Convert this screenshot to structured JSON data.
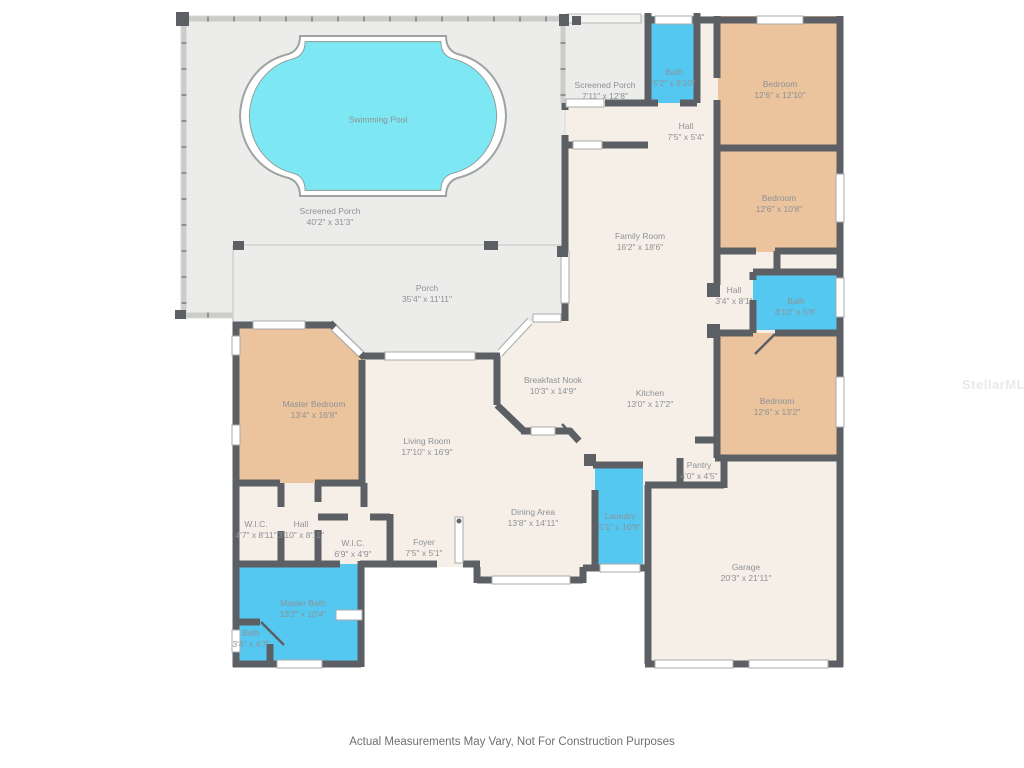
{
  "colors": {
    "pool": "#7DE8F4",
    "wet": "#55C8F2",
    "bedroom": "#EBC39D",
    "floor": "#F6EFE7",
    "porch": "#ECECEA",
    "wall": "#5C6064",
    "label": "#8C9296"
  },
  "rooms": [
    {
      "name": "Swimming Pool",
      "dims": ""
    },
    {
      "name": "Screened Porch",
      "dims": "40'2\" x 31'3\""
    },
    {
      "name": "Porch",
      "dims": "35'4\" x 11'11\""
    },
    {
      "name": "Screened Porch",
      "dims": "7'11\" x 12'8\""
    },
    {
      "name": "Bath",
      "dims": "5'2\" x 8'10\""
    },
    {
      "name": "Bedroom",
      "dims": "12'6\" x 12'10\""
    },
    {
      "name": "Hall",
      "dims": "7'5\" x 5'4\""
    },
    {
      "name": "Family Room",
      "dims": "16'2\" x 18'6\""
    },
    {
      "name": "Bedroom",
      "dims": "12'6\" x 10'8\""
    },
    {
      "name": "Hall",
      "dims": "3'4\" x 8'1\""
    },
    {
      "name": "Bath",
      "dims": "8'10\" x 5'6\""
    },
    {
      "name": "Bedroom",
      "dims": "12'6\" x 13'2\""
    },
    {
      "name": "Master Bedroom",
      "dims": "13'4\" x 16'8\""
    },
    {
      "name": "Living Room",
      "dims": "17'10\" x 16'9\""
    },
    {
      "name": "Breakfast Nook",
      "dims": "10'3\" x 14'9\""
    },
    {
      "name": "Kitchen",
      "dims": "13'0\" x 17'2\""
    },
    {
      "name": "Pantry",
      "dims": "4'0\" x 4'5\""
    },
    {
      "name": "Dining Area",
      "dims": "13'8\" x 14'11\""
    },
    {
      "name": "Laundry",
      "dims": "5'1\" x 10'8\""
    },
    {
      "name": "W.I.C.",
      "dims": "4'7\" x 8'11\""
    },
    {
      "name": "Hall",
      "dims": "3'10\" x 8'11\""
    },
    {
      "name": "W.I.C.",
      "dims": "6'9\" x 4'9\""
    },
    {
      "name": "Foyer",
      "dims": "7'5\" x 5'1\""
    },
    {
      "name": "Master Bath",
      "dims": "13'2\" x 10'4\""
    },
    {
      "name": "Bath",
      "dims": "3'4\" x 4'7\""
    },
    {
      "name": "Garage",
      "dims": "20'3\" x 21'11\""
    }
  ],
  "disclaimer": "Actual Measurements May Vary, Not For Construction Purposes",
  "watermark": "StellarMLS"
}
